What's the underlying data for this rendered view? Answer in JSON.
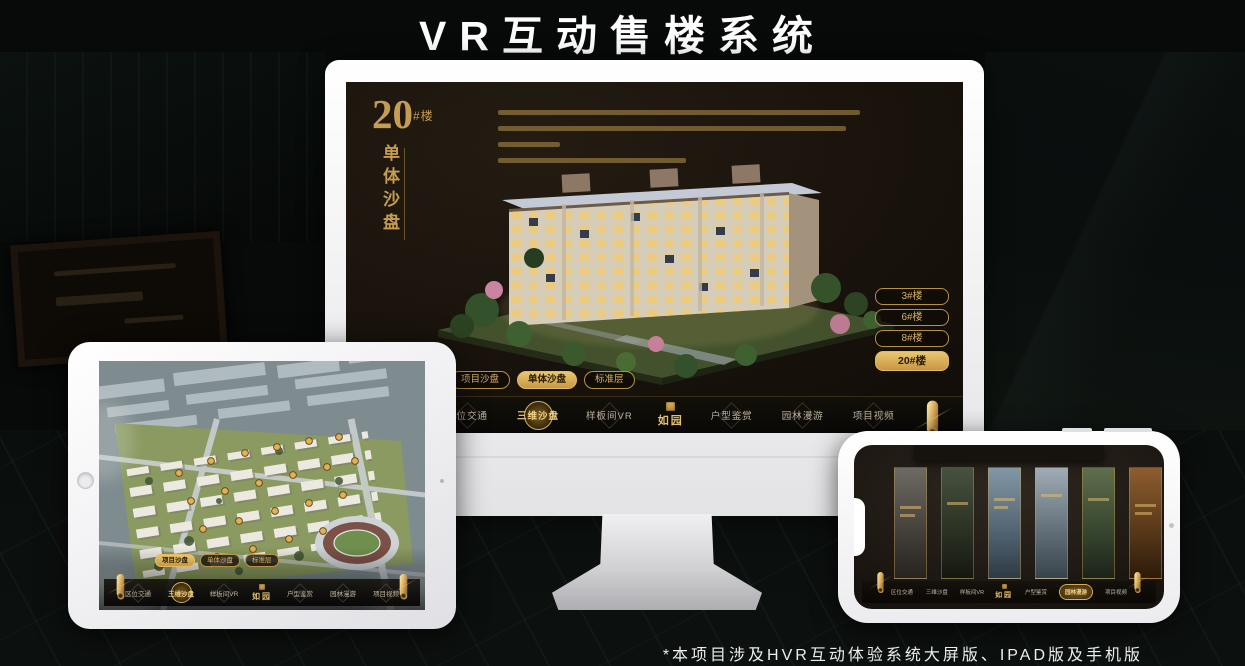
{
  "page": {
    "title": "VR互动售楼系统",
    "footnote": "*本项目涉及HVR互动体验系统大屏版、IPAD版及手机版"
  },
  "colors": {
    "gold": "#C59D52",
    "gold_bright": "#E9C76F",
    "screen_bg": "#17110B",
    "frame_white": "#FFFFFF"
  },
  "app": {
    "logo": "如园",
    "logo_seal_icon": "seal-stamp-icon",
    "scroll_icon": "scroll-handle-icon",
    "nav_items": [
      {
        "label": "区位交通"
      },
      {
        "label": "三维沙盘"
      },
      {
        "label": "样板间VR"
      },
      {
        "label": "户型鉴赏"
      },
      {
        "label": "园林漫游"
      },
      {
        "label": "项目视频"
      }
    ]
  },
  "monitor": {
    "heading_number": "20",
    "heading_suffix": "#楼",
    "heading_vertical": "单体沙盘",
    "active_nav": "三维沙盘",
    "floor_buttons": [
      {
        "label": "3#楼",
        "active": false
      },
      {
        "label": "6#楼",
        "active": false
      },
      {
        "label": "8#楼",
        "active": false
      },
      {
        "label": "20#楼",
        "active": true
      }
    ],
    "sub_tabs": [
      {
        "label": "项目沙盘",
        "active": false
      },
      {
        "label": "单体沙盘",
        "active": true
      },
      {
        "label": "标准层",
        "active": false
      }
    ]
  },
  "tablet": {
    "active_nav": "三维沙盘",
    "sub_tabs": [
      {
        "label": "项目沙盘",
        "active": true
      },
      {
        "label": "单体沙盘",
        "active": false
      },
      {
        "label": "标准层",
        "active": false
      }
    ]
  },
  "phone": {
    "active_nav": "园林漫游",
    "panel_count": 6
  }
}
